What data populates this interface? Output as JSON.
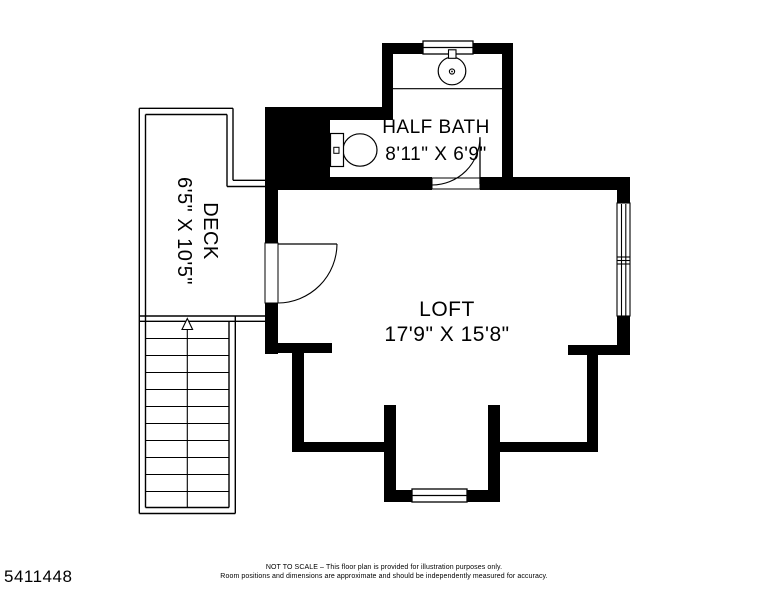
{
  "colors": {
    "wall": "#000000",
    "background": "#ffffff"
  },
  "rooms": {
    "half_bath": {
      "name": "HALF BATH",
      "dims": "8'11\" X 6'9\""
    },
    "loft": {
      "name": "LOFT",
      "dims": "17'9\" X 15'8\""
    },
    "deck": {
      "name": "DECK",
      "dims": "6'5\" X 10'5\""
    }
  },
  "fixtures": {
    "sink": "sink-icon",
    "toilet": "toilet-icon",
    "stairs_direction": "up-arrow-icon"
  },
  "footer": {
    "listing_id": "5411448",
    "disclaimer_line1": "NOT TO SCALE – This floor plan is provided for illustration purposes only.",
    "disclaimer_line2": "Room positions and dimensions are approximate and should be independently measured for accuracy."
  }
}
